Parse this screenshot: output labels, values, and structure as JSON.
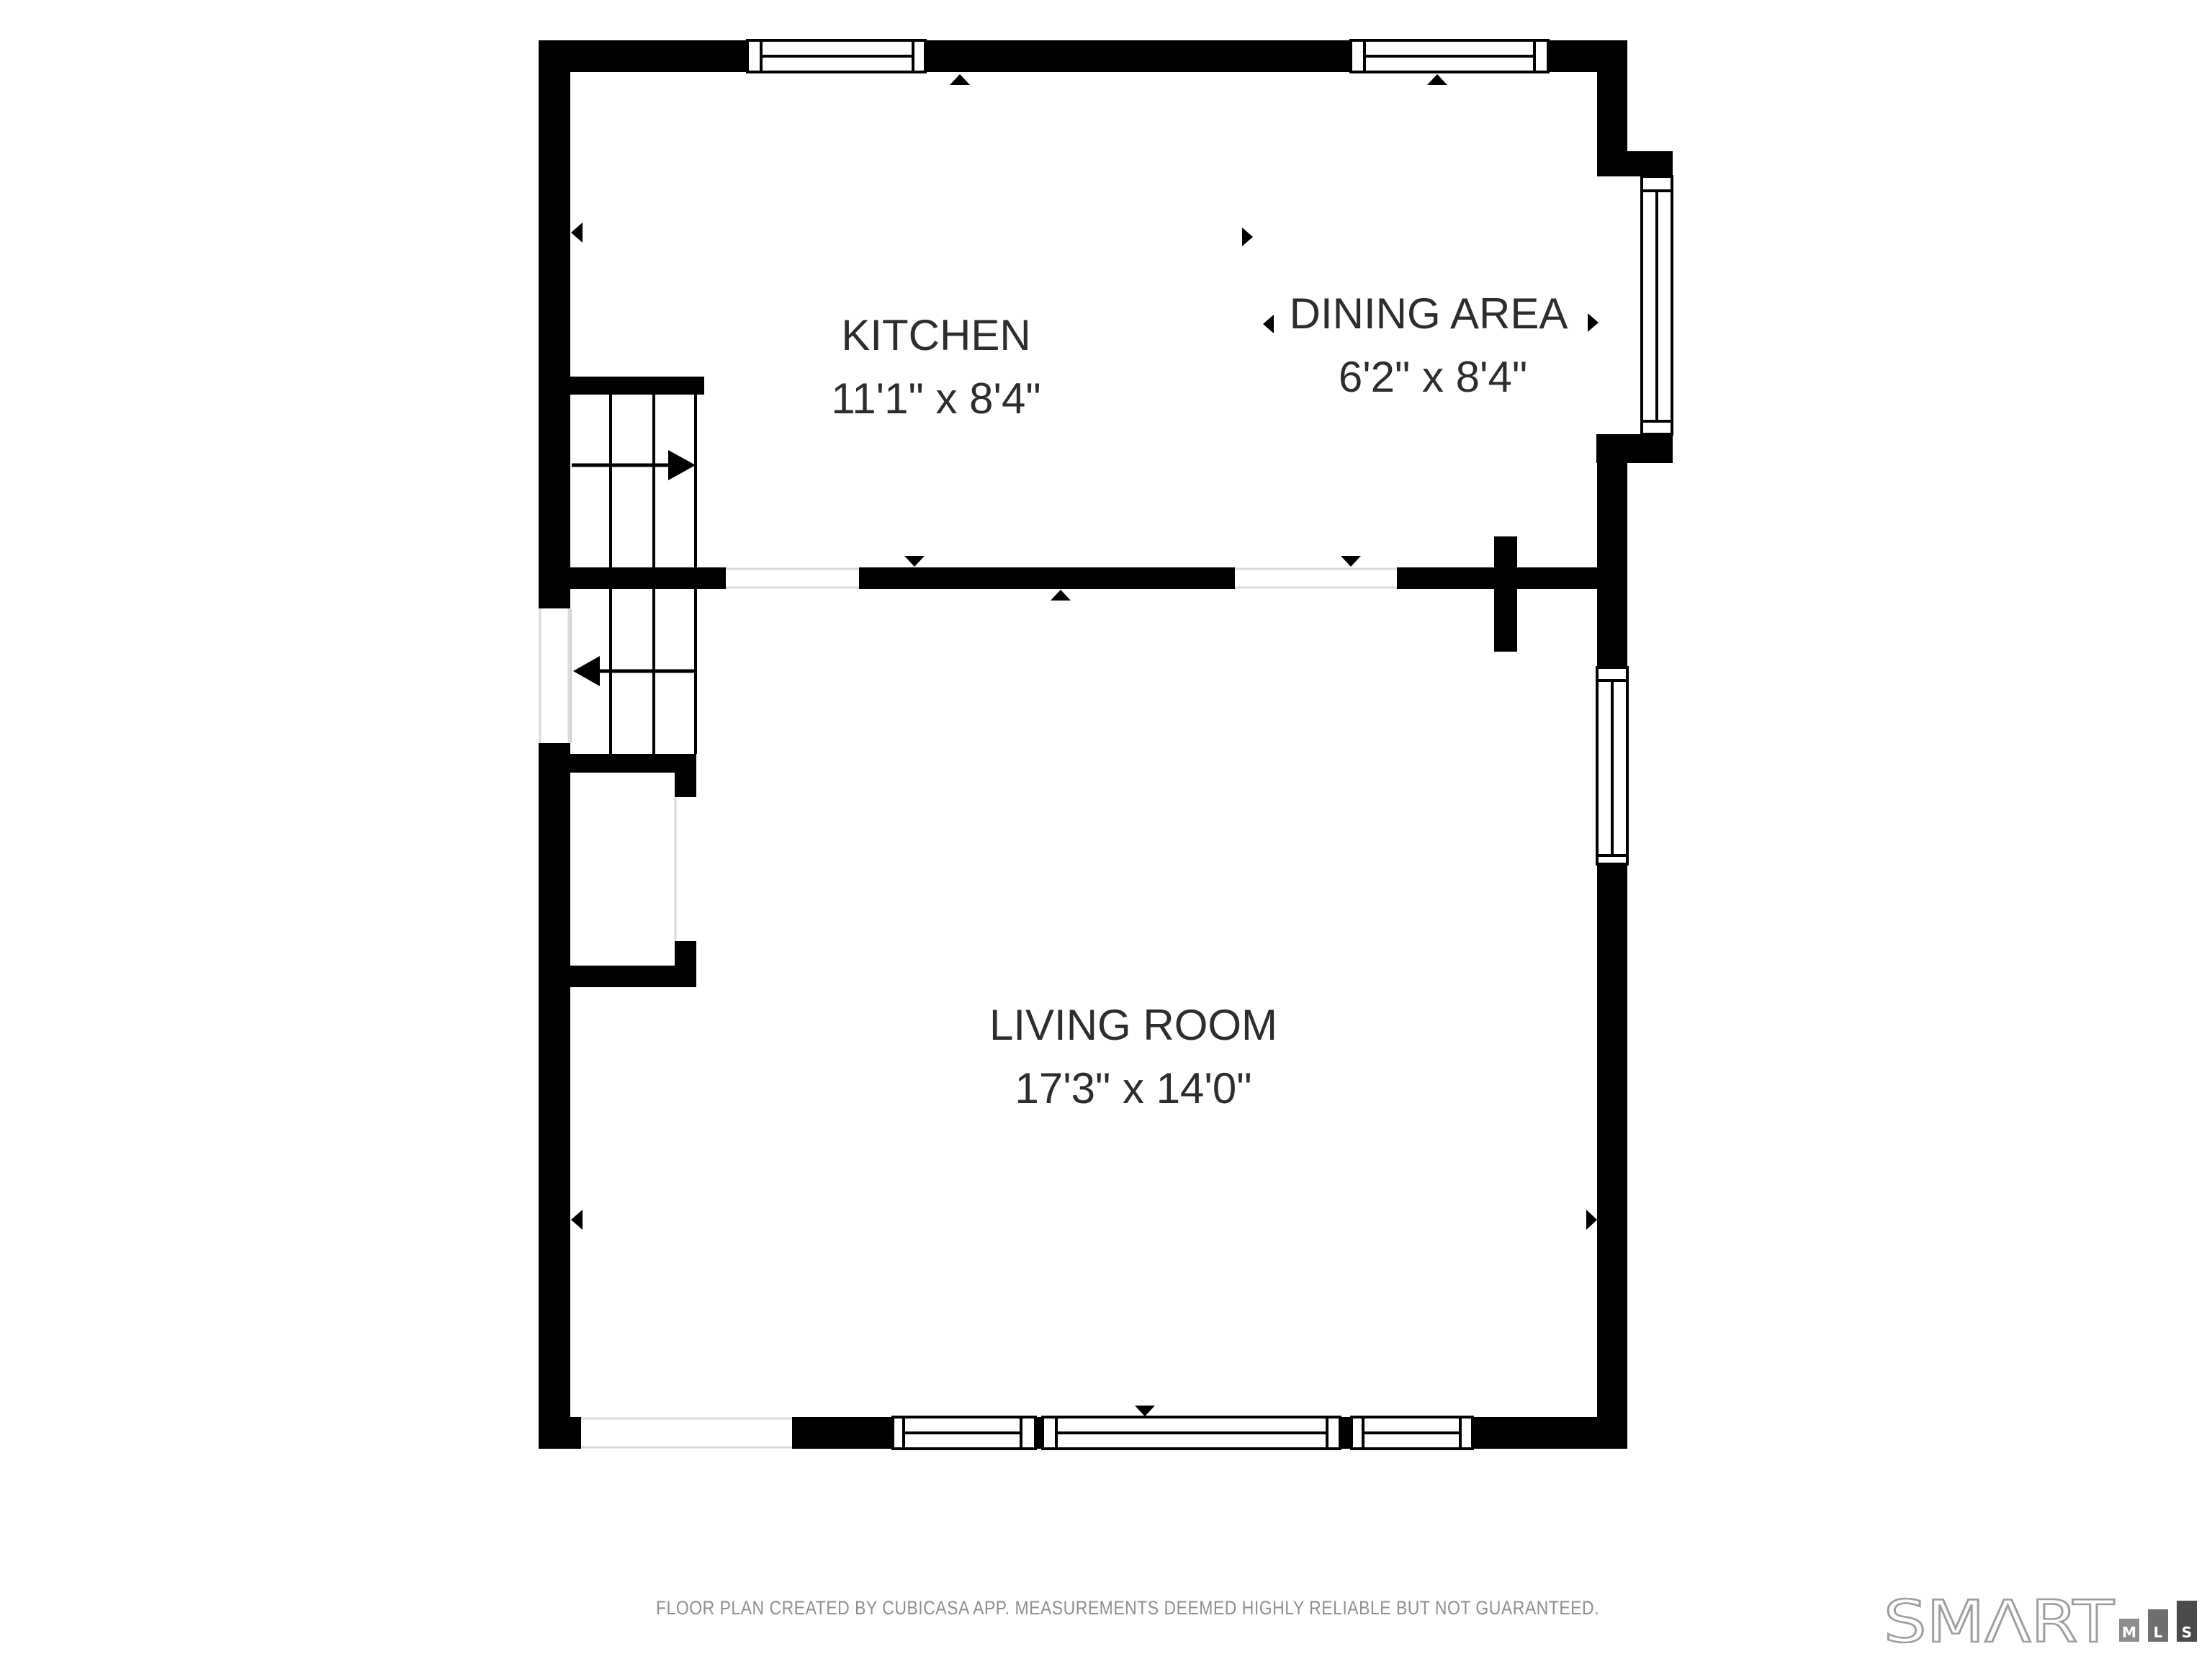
{
  "floor_plan": {
    "rooms": [
      {
        "name": "KITCHEN",
        "dimensions": "11'1\" x 8'4\""
      },
      {
        "name": "DINING AREA",
        "dimensions": "6'2\" x 8'4\""
      },
      {
        "name": "LIVING ROOM",
        "dimensions": "17'3\" x 14'0\""
      }
    ],
    "footer": {
      "disclaimer": "FLOOR PLAN CREATED BY CUBICASA APP. MEASUREMENTS DEEMED HIGHLY RELIABLE BUT NOT GUARANTEED."
    },
    "logo": {
      "brand": "SMΛRT",
      "blocks": [
        {
          "label": "M",
          "color": "#8d8d8d"
        },
        {
          "label": "L",
          "color": "#6f6f6f"
        },
        {
          "label": "S",
          "color": "#4b4b4b"
        }
      ],
      "outline_color": "#9e9e9e"
    },
    "colors": {
      "wall": "#000000",
      "background": "#ffffff",
      "label_text": "#2d2d2d",
      "footer_text": "#8f8f8f",
      "door_hairline": "#d9d9d9"
    }
  }
}
